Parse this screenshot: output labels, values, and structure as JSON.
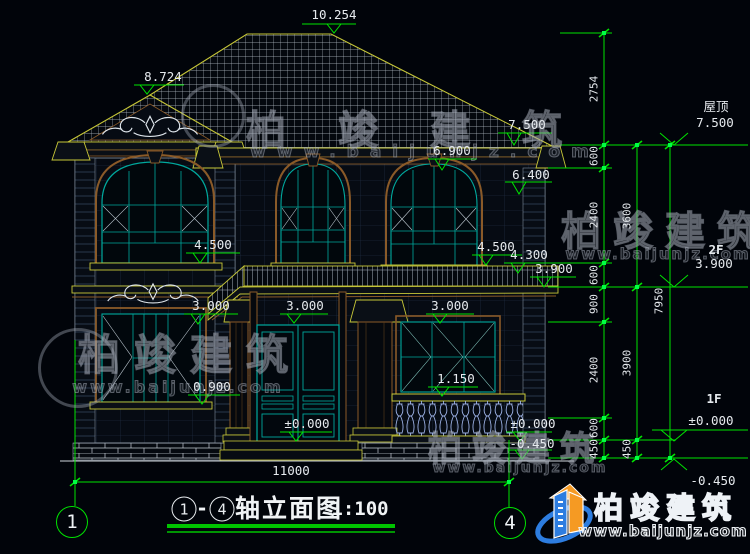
{
  "colors": {
    "background": "#01040a",
    "dimension_green": "#00e400",
    "text_white": "#e6eaee",
    "roof_outline_yellow": "#c8c838",
    "window_frame_teal": "#00a89d",
    "trim_brown": "#8a5a28",
    "baluster_blue": "#9db2e6",
    "logo_blue": "#2d7de0",
    "logo_orange": "#f59a23"
  },
  "drawing": {
    "levels": {
      "ridge": "10.254",
      "gable_peak": "8.724",
      "eave": "7.500",
      "cornice_bottom": "6.900",
      "window2f_top": "6.400",
      "sill2f_left": "4.500",
      "sill2f_right": "4.500",
      "porch_roof": "4.300",
      "floor2_edge": "3.900",
      "window1f_top_left": "3.000",
      "window1f_top_center": "3.000",
      "window1f_top_right": "3.000",
      "railing_top": "1.150",
      "sill1f_left": "0.900",
      "door_ground": "±0.000",
      "side_ground_zero": "±0.000",
      "side_ground_neg": "-0.450"
    }
  },
  "right_margin": {
    "roof_label": "屋顶",
    "roof_level": "7.500",
    "f2_label": "2F",
    "f2_level": "3.900",
    "f1_label": "1F",
    "f1_level": "±0.000",
    "below_ground": "-0.450",
    "chain_inner": [
      "2754",
      "600",
      "2400",
      "600",
      "900",
      "2400",
      "600",
      "450"
    ],
    "chain_mid": [
      "3600",
      "3900",
      "450"
    ],
    "chain_total": "7950"
  },
  "bottom": {
    "width_dim": "11000",
    "axis_left": "1",
    "axis_right": "4",
    "title_axis_from": "1",
    "title_dash": "-",
    "title_axis_to": "4",
    "title_text": "轴立面图",
    "title_scale": "1:100"
  },
  "watermark": {
    "brand": "柏竣建筑",
    "url": "www.baijunjz.com"
  },
  "logo": {
    "brand": "柏竣建筑",
    "url": "www.baijunjz.com"
  }
}
